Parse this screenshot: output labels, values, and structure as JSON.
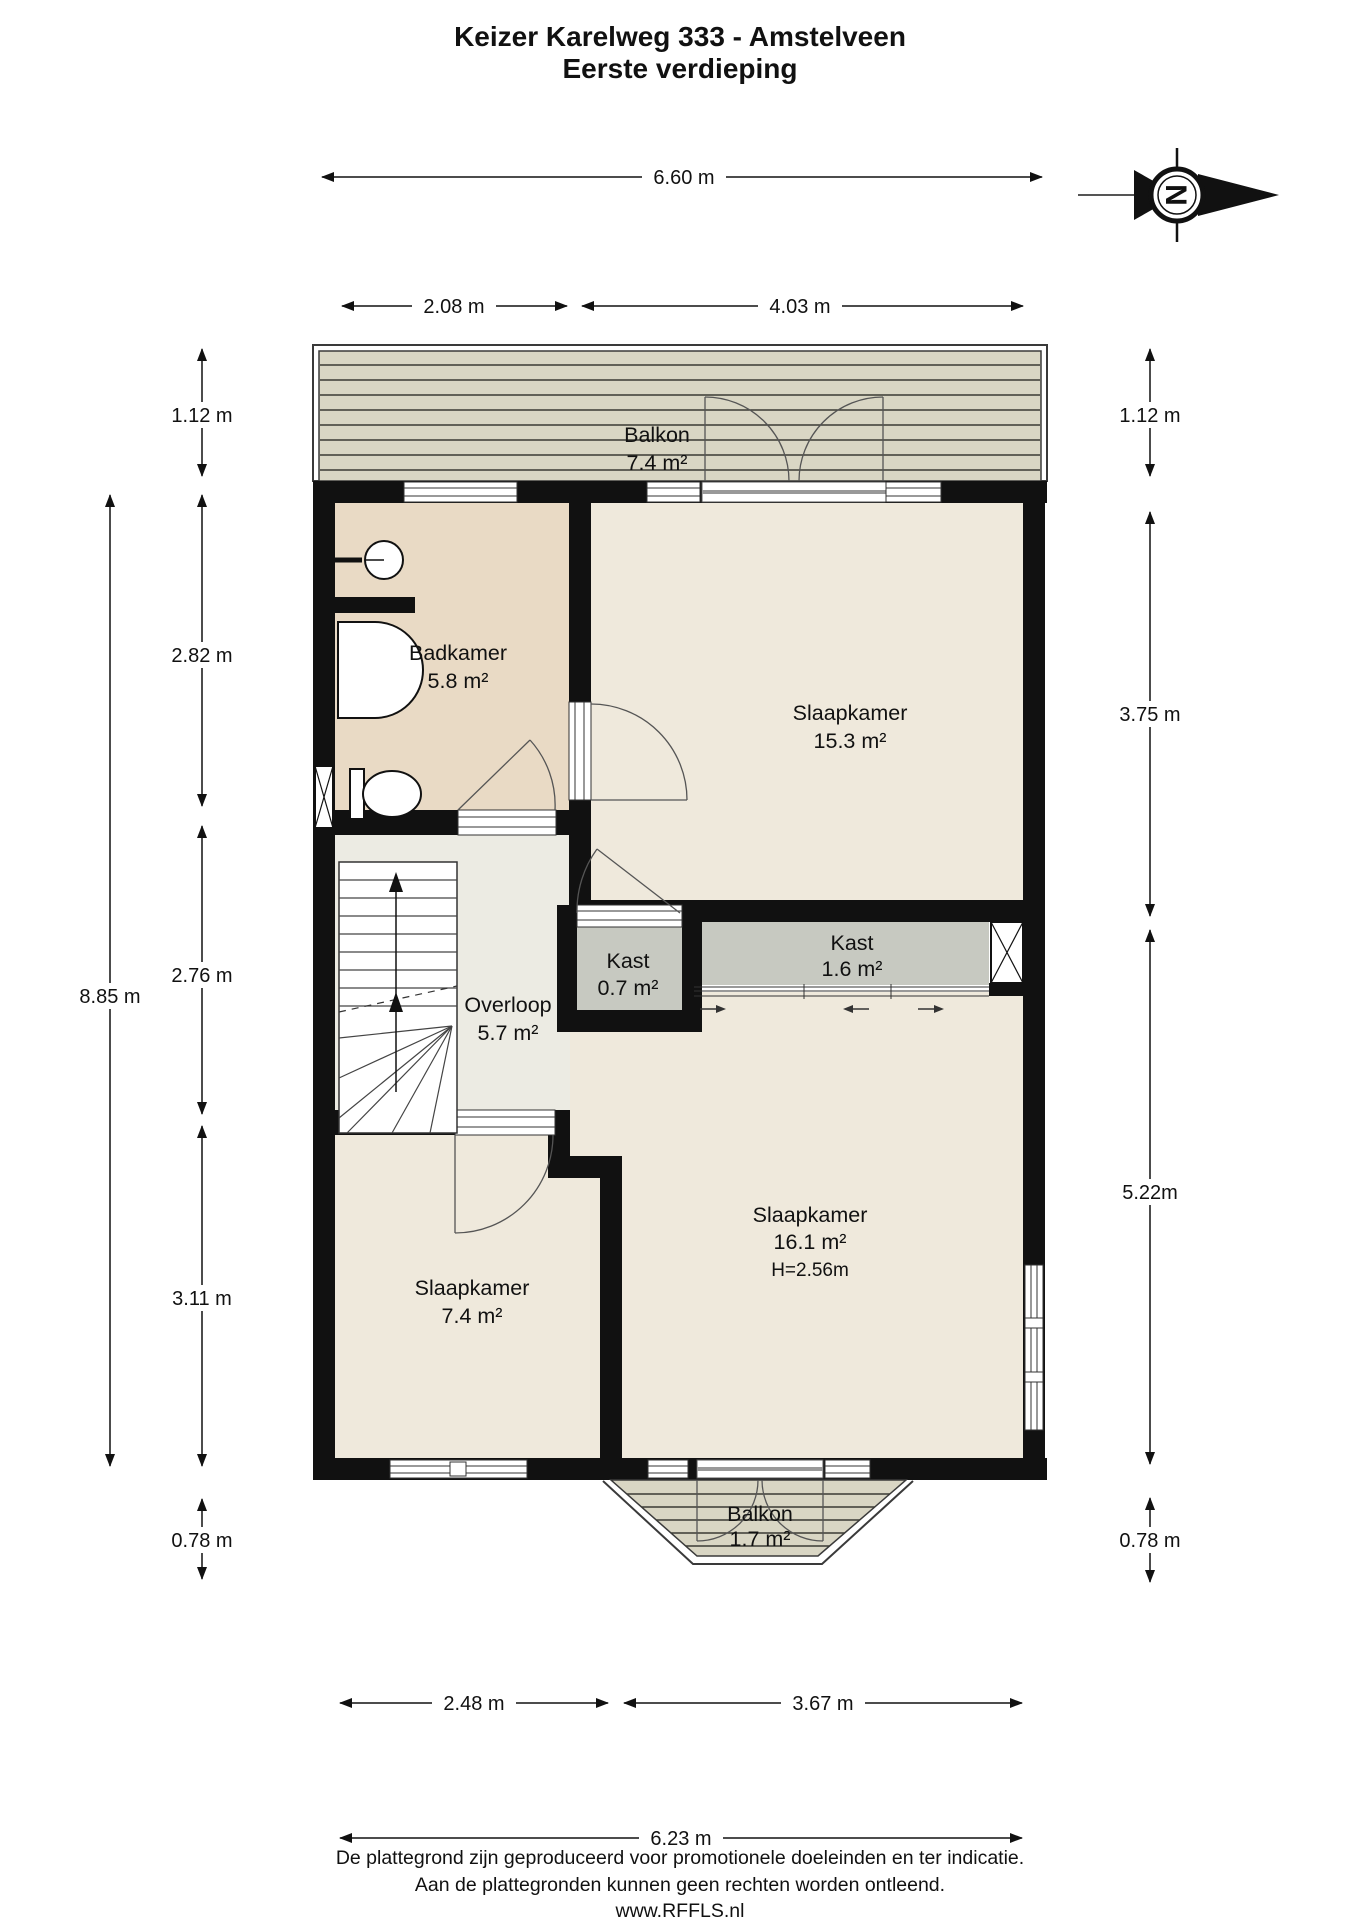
{
  "title": {
    "line1": "Keizer Karelweg 333 - Amstelveen",
    "line2": "Eerste verdieping"
  },
  "compass": {
    "letter": "N"
  },
  "rooms": {
    "balkon_top": {
      "name": "Balkon",
      "area": "7.4 m²"
    },
    "badkamer": {
      "name": "Badkamer",
      "area": "5.8 m²"
    },
    "slaapkamer_1": {
      "name": "Slaapkamer",
      "area": "15.3 m²"
    },
    "overloop": {
      "name": "Overloop",
      "area": "5.7 m²"
    },
    "kast_klein": {
      "name": "Kast",
      "area": "0.7 m²"
    },
    "kast_groot": {
      "name": "Kast",
      "area": "1.6 m²"
    },
    "slaapkamer_2": {
      "name": "Slaapkamer",
      "area": "16.1 m²",
      "height": "H=2.56m"
    },
    "slaapkamer_3": {
      "name": "Slaapkamer",
      "area": "7.4 m²"
    },
    "balkon_onder": {
      "name": "Balkon",
      "area": "1.7 m²"
    }
  },
  "dimensions": {
    "top": [
      "6.60 m",
      "2.08 m",
      "4.03 m"
    ],
    "left": [
      "1.12 m",
      "2.82 m",
      "2.76 m",
      "3.11 m",
      "0.78 m"
    ],
    "left_total": "8.85 m",
    "right": [
      "1.12 m",
      "3.75 m",
      "5.22m",
      "0.78 m"
    ],
    "bottom": [
      "2.48 m",
      "3.67 m"
    ],
    "bottom_total": "6.23 m"
  },
  "footer": {
    "line1": "De plattegrond zijn geproduceerd voor promotionele doeleinden en ter indicatie.",
    "line2": "Aan de plattegronden kunnen geen rechten worden ontleend.",
    "line3": "www.RFFLS.nl"
  },
  "colors": {
    "wall": "#111111",
    "room_fill": "#efe9dc",
    "hall_fill": "#ecebe3",
    "bathroom_fill": "#e9dac5",
    "closet_fill": "#c7c9c1",
    "balcony_fill": "#d9d6c4"
  }
}
